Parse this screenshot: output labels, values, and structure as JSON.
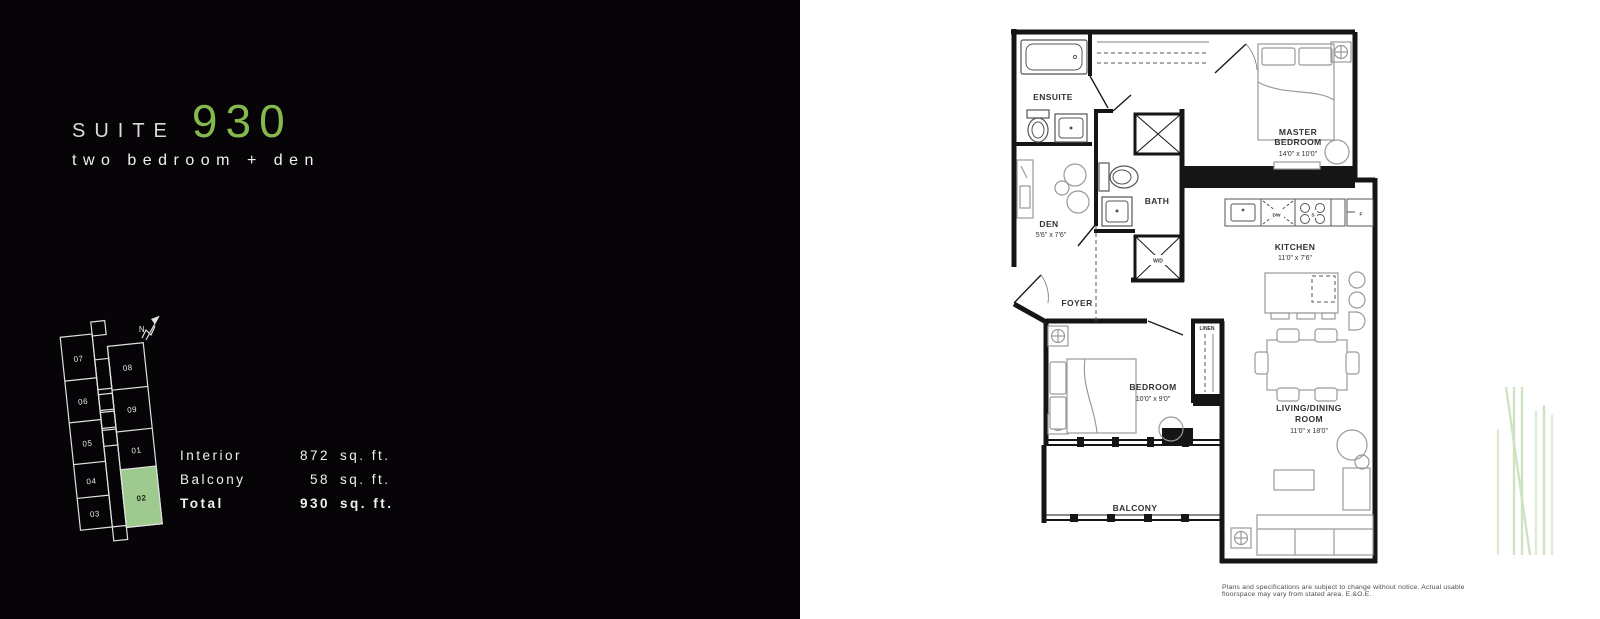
{
  "header": {
    "suite_label": "SUITE",
    "suite_number": "930",
    "subtitle": "two bedroom + den"
  },
  "colors": {
    "accent_green": "#84b94e",
    "keyplan_highlight": "#9ec98f",
    "panel_background": "#070408"
  },
  "stats": {
    "rows": [
      {
        "label": "Interior",
        "value": "872",
        "unit": "sq. ft."
      },
      {
        "label": "Balcony",
        "value": "58",
        "unit": "sq. ft."
      },
      {
        "label": "Total",
        "value": "930",
        "unit": "sq. ft."
      }
    ]
  },
  "keyplan": {
    "north": "N",
    "left_units": [
      "07",
      "06",
      "05",
      "04",
      "03"
    ],
    "right_units": [
      "08",
      "09",
      "01",
      "02"
    ],
    "highlighted_unit": "02"
  },
  "floorplan": {
    "rooms": {
      "ensuite": {
        "name": "ENSUITE"
      },
      "master": {
        "line1": "MASTER",
        "line2": "BEDROOM",
        "dim": "14'0\" x 10'0\""
      },
      "bath": {
        "name": "BATH"
      },
      "den": {
        "name": "DEN",
        "dim": "5'6\" x 7'6\""
      },
      "wd": {
        "name": "W/D"
      },
      "kitchen": {
        "name": "KITCHEN",
        "dim": "11'0\" x 7'6\""
      },
      "foyer": {
        "name": "FOYER"
      },
      "bedroom": {
        "name": "BEDROOM",
        "dim": "10'0\" x 9'0\""
      },
      "linen": {
        "name": "LINEN"
      },
      "living": {
        "line1": "LIVING/DINING",
        "line2": "ROOM",
        "dim": "11'0\" x 18'0\""
      },
      "balcony": {
        "name": "BALCONY"
      }
    },
    "appliances": {
      "dishwasher": "DW",
      "stove": "S",
      "fridge": "F"
    }
  },
  "disclaimer": "Plans and specifications are subject to change without notice. Actual usable floorspace may vary from stated area. E.&O.E."
}
